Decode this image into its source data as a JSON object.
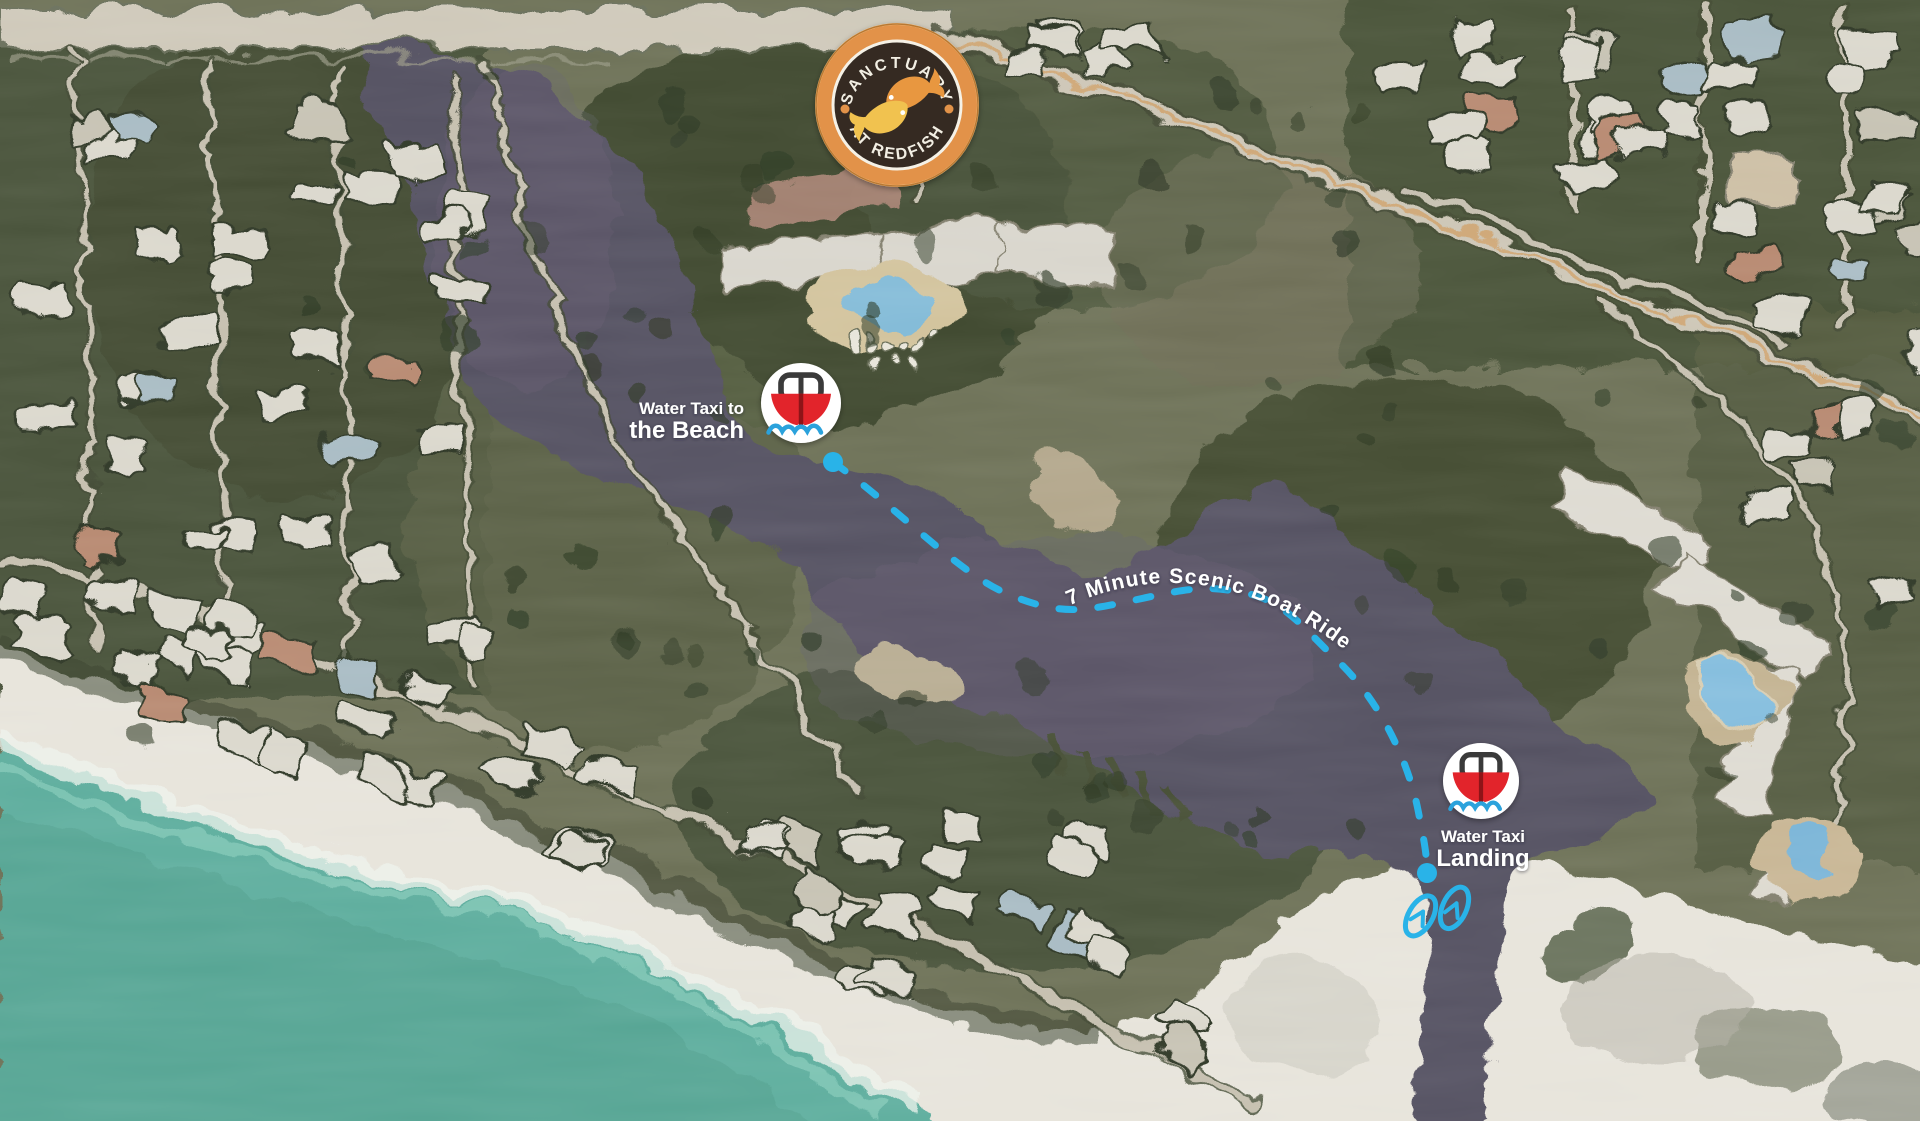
{
  "logo": {
    "arc_top": "SANCTUARY",
    "arc_bottom": "AT REDFISH"
  },
  "markers": {
    "beach": {
      "line1": "Water Taxi to",
      "line2": "the Beach"
    },
    "landing": {
      "line1": "Water Taxi",
      "line2": "Landing"
    }
  },
  "route": {
    "label": "7 Minute Scenic Boat Ride"
  },
  "icons": {
    "boat": "boat-icon",
    "flip_flops": "flip-flops-icon",
    "fish": "redfish-icon"
  },
  "colors": {
    "route_cyan": "#29B3E8",
    "boat_red": "#E2242B",
    "boat_dark_red": "#8E1418",
    "wave_blue": "#2BA2DC",
    "logo_orange": "#E29248",
    "logo_brown": "#342B23",
    "fish_orange": "#E8973F",
    "fish_gold": "#F1C24F",
    "lake": "#575263",
    "ocean": "#5FAE9E",
    "sand": "#E7E4DB"
  }
}
